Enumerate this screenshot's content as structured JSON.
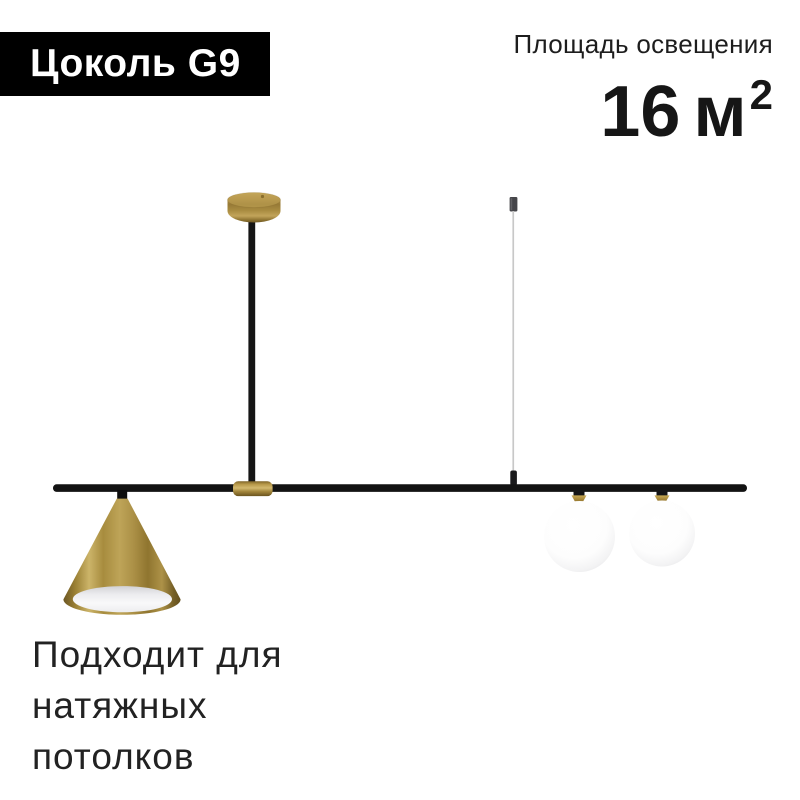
{
  "badge": {
    "label": "Цоколь G9"
  },
  "lighting_area": {
    "label": "Площадь освещения",
    "value": "16",
    "unit": "м",
    "superscript": "2"
  },
  "footer_note": {
    "lines": [
      "Подходит для",
      "натяжных",
      "потолков"
    ]
  },
  "product_visual": {
    "type": "pendant-ceiling-lamp-photo",
    "parts": [
      "ceiling-canopy",
      "vertical-rod",
      "suspension-wire",
      "horizontal-bar",
      "brass-sleeve",
      "cone-shade",
      "glass-sphere-left",
      "glass-sphere-right"
    ]
  },
  "colors": {
    "badge_background": "#000000",
    "badge_text": "#ffffff",
    "heading_text": "#1d1d1d",
    "body_text": "#222222",
    "brass": "#a98b3f",
    "metal_black": "#141414",
    "glass_white": "#f6f6f7",
    "wire_gray": "#c8c8c8",
    "background": "#ffffff"
  }
}
